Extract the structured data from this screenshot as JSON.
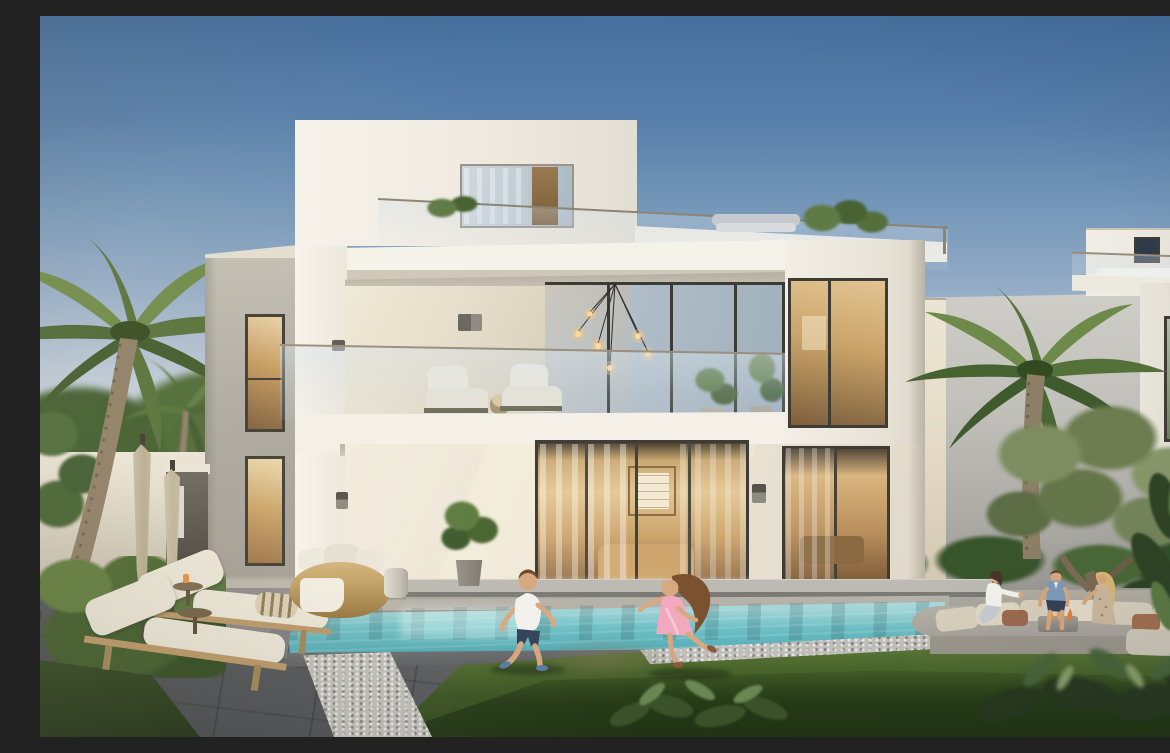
{
  "scene": {
    "description": "Dusk architectural rendering of a modern white two-storey villa with glass balcony and roof terrace; swimming pool and lawn in front; a boy and a girl in a pink dress run on the grass while three adults chat on a sunken outdoor sofa by a fire table; palm trees, an olive tree and neighbouring villas surround the garden",
    "time_of_day": "dusk",
    "colors": {
      "sky_top": "#46709f",
      "sky_horizon": "#e6e2da",
      "villa_white": "#f3efe7",
      "villa_cream": "#efe9dd",
      "wing_gray": "#aeaaa1",
      "window_frame": "#3f3c35",
      "glass_blue": "#b7c3cd",
      "interior_warm": "#d9b57f",
      "interior_deep": "#8a6844",
      "pool_light": "#9fd4d6",
      "pool_mid": "#6fc0c6",
      "pool_deep": "#49a3ae",
      "coping_dark": "#5d6063",
      "paving_dark": "#3f4347",
      "gravel": "#c2c0bb",
      "grass_light": "#7f9b52",
      "grass_dark": "#2e481c",
      "hedge_green": "#4a682f",
      "palm_green": "#5c7d3e",
      "olive_green": "#7d8d60",
      "umbrella_beige": "#c9bfa6",
      "cushion_white": "#eae5d7",
      "wicker_tan": "#bf9f63",
      "wood_tan": "#b99868",
      "sofa_beige": "#d9d0bd",
      "stone_gray": "#a8a49c",
      "dress_pink": "#f2a8bd",
      "shirt_blue": "#7e9cb8",
      "shorts_navy": "#33415a",
      "skin": "#d8a880",
      "fire_orange": "#e8923f"
    },
    "objects": [
      "main-villa",
      "left-wing",
      "penthouse",
      "roof-terrace",
      "balcony",
      "glass-railing",
      "pendant-lights",
      "living-room-sliders",
      "wall-sconces",
      "swimming-pool",
      "lawn",
      "stone-deck",
      "gravel-border",
      "hedge",
      "closed-umbrellas",
      "sun-loungers",
      "wicker-daybed",
      "potted-shrub",
      "sunken-lounge-sofa",
      "fire-table",
      "olive-tree",
      "palm-trees",
      "neighbour-villa-right",
      "foreground-plants"
    ],
    "people": {
      "children": [
        {
          "name": "running-boy",
          "clothes": "white t-shirt, navy shorts, blue sneakers"
        },
        {
          "name": "running-girl",
          "clothes": "pink dress, sandals, long brown hair"
        }
      ],
      "adults": [
        {
          "name": "seated-woman-dark-hair",
          "clothes": "white blouse, light jeans"
        },
        {
          "name": "seated-man",
          "clothes": "blue shirt, navy shorts"
        },
        {
          "name": "seated-woman-blonde",
          "clothes": "patterned boho dress"
        }
      ]
    },
    "counts": {
      "umbrellas": 2,
      "loungers": 2,
      "balcony_chairs": 2,
      "adults": 3,
      "children": 2
    }
  }
}
